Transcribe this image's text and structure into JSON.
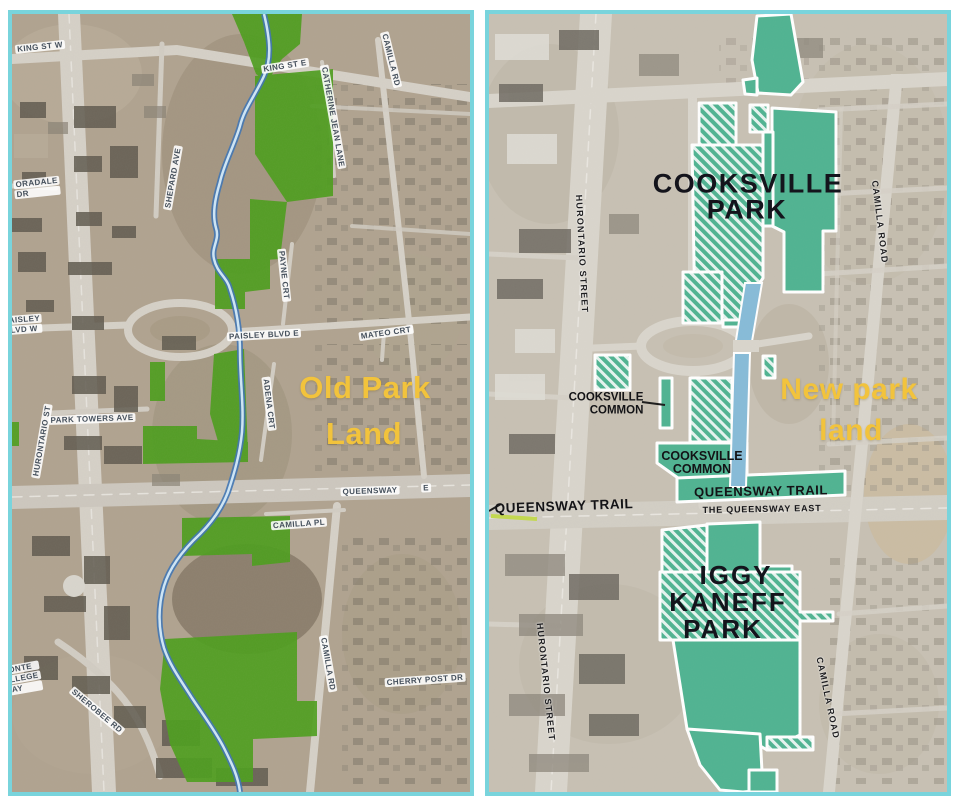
{
  "figure": {
    "left_panel_name": "Old park land aerial map",
    "right_panel_name": "New park land aerial map"
  },
  "colors": {
    "map_border_cyan": "#79d4dc",
    "old_park_green": "#4d9e1d",
    "new_park_teal": "#4fb391",
    "annotation_gold": "#f2c33c",
    "creek_blue": "#3f74b4",
    "channel_blue": "#86bbd8",
    "trail_line_yellow_green": "#c3d94e",
    "big_label_black": "#14141c"
  },
  "left_map": {
    "annotation": {
      "line1": "Old Park",
      "line2": "Land"
    },
    "streets": {
      "king_st_w": "KING ST W",
      "king_st_e": "KING ST E",
      "camilla_rd_top": "CAMILLA RD",
      "catherine_jean_lane": "CATHERINE JEAN LANE",
      "shepard_ave": "SHEPARD AVE",
      "oradale_line1": "ORADALE",
      "oradale_line2": "DR",
      "paisley_w_line1": "PAISLEY",
      "paisley_w_line2": "BLVD W",
      "hurontario_st": "HURONTARIO ST",
      "park_towers_ave": "PARK TOWERS AVE",
      "paisley_blvd_e": "PAISLEY BLVD E",
      "payne_crt": "PAYNE CRT",
      "adena_crt": "ADENA CRT",
      "mateo_crt": "MATEO CRT",
      "queensway": "QUEENSWAY",
      "queensway_e": "E",
      "camilla_pl": "CAMILLA PL",
      "camilla_rd": "CAMILLA RD",
      "cherry_post_dr": "CHERRY POST DR",
      "sherobee_rd": "SHEROBEE RD",
      "partial_line1": "ONTE",
      "partial_line2": "LLEGE",
      "partial_line3": "AY"
    }
  },
  "right_map": {
    "annotation": {
      "line1": "New park",
      "line2": "land"
    },
    "parks": {
      "cooksville_line1": "COOKSVILLE",
      "cooksville_line2": "PARK",
      "iggy_line1": "IGGY",
      "iggy_line2": "KANEFF",
      "iggy_line3": "PARK"
    },
    "commons": {
      "callout_line1": "COOKSVILLE",
      "callout_line2": "COMMON",
      "inner_line1": "COOKSVILLE",
      "inner_line2": "COMMON"
    },
    "trails": {
      "band_label": "QUEENSWAY TRAIL",
      "left_label": "QUEENSWAY TRAIL"
    },
    "streets": {
      "hurontario_street": "HURONTARIO STREET",
      "camilla_road": "CAMILLA ROAD",
      "the_queensway_east": "THE QUEENSWAY EAST"
    }
  }
}
